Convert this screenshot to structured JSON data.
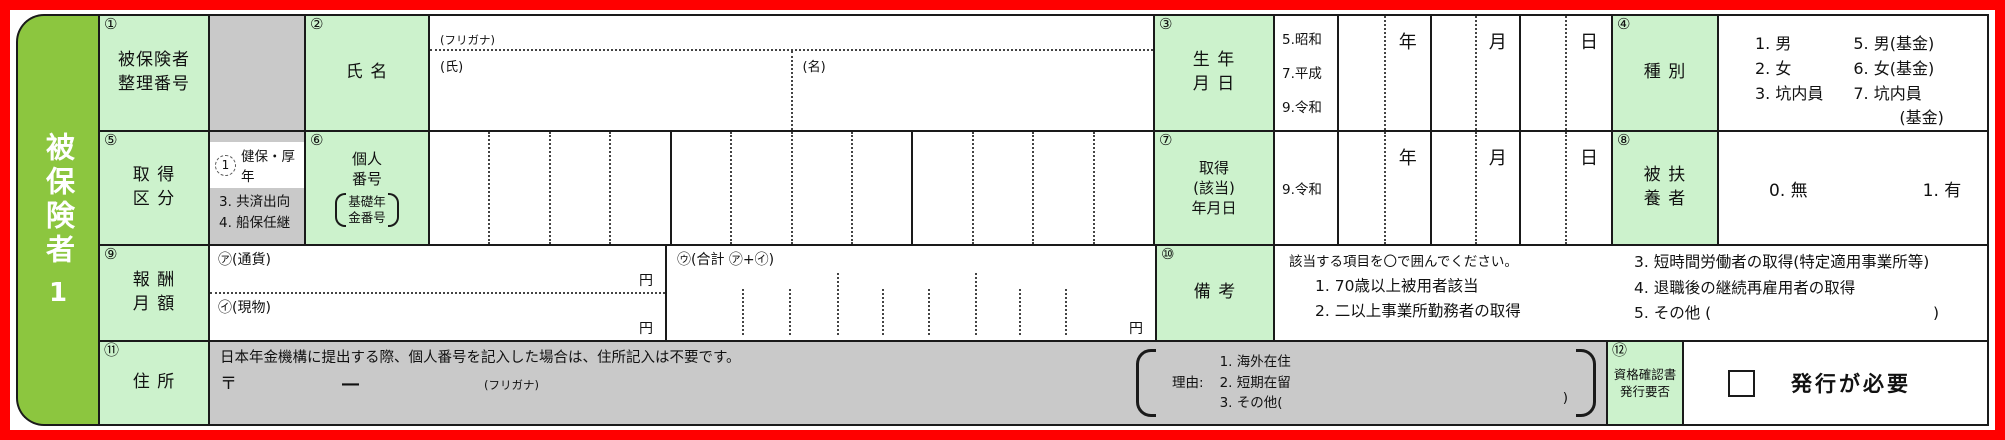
{
  "sidebar": {
    "title": "被保険者",
    "number": "1"
  },
  "fields": {
    "f1": {
      "no": "①",
      "l1": "被保険者",
      "l2": "整理番号"
    },
    "f2": {
      "no": "②",
      "label": "氏 名",
      "furigana": "(フリガナ)",
      "family": "(氏)",
      "given": "(名)"
    },
    "f3": {
      "no": "③",
      "l1": "生 年",
      "l2": "月 日",
      "eras": [
        "5.昭和",
        "7.平成",
        "9.令和"
      ],
      "year": "年",
      "month": "月",
      "day": "日"
    },
    "f4": {
      "no": "④",
      "label": "種 別",
      "left": [
        "1. 男",
        "2. 女",
        "3. 坑内員"
      ],
      "right": [
        "5. 男(基金)",
        "6. 女(基金)",
        "7. 坑内員",
        "(基金)"
      ]
    },
    "f5": {
      "no": "⑤",
      "l1": "取 得",
      "l2": "区 分",
      "opt1_num": "1",
      "opt1": "健保・厚年",
      "opt3": "3. 共済出向",
      "opt4": "4. 船保任継"
    },
    "f6": {
      "no": "⑥",
      "l1": "個人",
      "l2": "番号",
      "b1": "基礎年",
      "b2": "金番号"
    },
    "f7": {
      "no": "⑦",
      "l1": "取得",
      "l2": "(該当)",
      "l3": "年月日",
      "era": "9.令和",
      "year": "年",
      "month": "月",
      "day": "日"
    },
    "f8": {
      "no": "⑧",
      "l1": "被 扶",
      "l2": "養 者",
      "opt_no": "0. 無",
      "opt_yes": "1. 有"
    },
    "f9": {
      "no": "⑨",
      "l1": "報 酬",
      "l2": "月 額",
      "currency": "㋐(通貨)",
      "inkind": "㋑(現物)",
      "total": "㋒(合計 ㋐+㋑)",
      "yen": "円"
    },
    "f10": {
      "no": "⑩",
      "label": "備 考",
      "inst": "該当する項目を〇で囲んでください。",
      "i1": "1. 70歳以上被用者該当",
      "i2": "2. 二以上事業所勤務者の取得",
      "i3": "3. 短時間労働者の取得(特定適用事業所等)",
      "i4": "4. 退職後の継続再雇用者の取得",
      "i5": "5. その他 (",
      "i5close": ")"
    },
    "f11": {
      "no": "⑪",
      "label": "住 所",
      "note": "日本年金機構に提出する際、個人番号を記入した場合は、住所記入は不要です。",
      "postal": "〒",
      "dash": "―",
      "furigana": "(フリガナ)",
      "reason": "理由:",
      "r1": "1. 海外在住",
      "r2": "2. 短期在留",
      "r3": "3. その他(",
      "rclose": ")"
    },
    "f12": {
      "no": "⑫",
      "l1": "資格確認書",
      "l2": "発行要否",
      "cb": "発行が必要"
    }
  },
  "colors": {
    "frame_red": "#ff0000",
    "tab_green": "#8cc63f",
    "label_green": "#ccf2cc",
    "gray": "#c9c9c9",
    "line": "#1a1a1a"
  }
}
